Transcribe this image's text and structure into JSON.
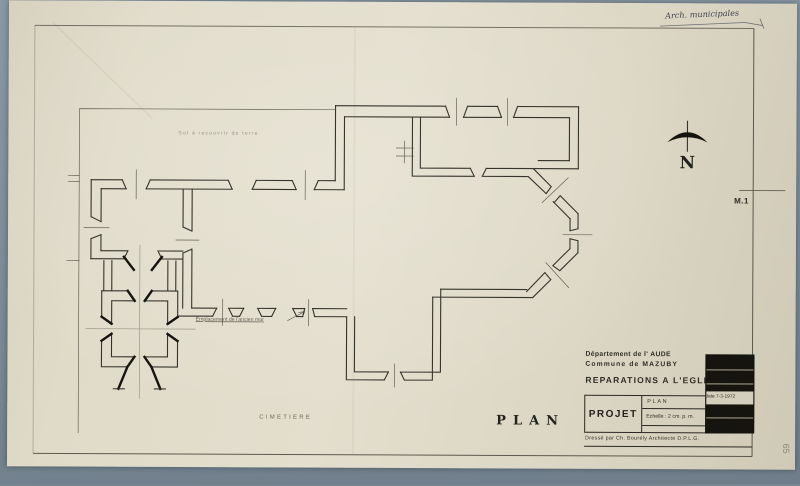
{
  "scan": {
    "annotation_top_right": "Arch. municipales",
    "sheet_tab": "M.1",
    "pencil_mark": "65"
  },
  "plan": {
    "caption": "PLAN",
    "yard_label": "Sol à recouvrir de terre",
    "wall_note": "Emplacement de l'ancien mur",
    "cemetery_label": "CIMETIERE",
    "north_letter": "N"
  },
  "title_block": {
    "department": "Département de l' AUDE",
    "commune": "Commune de  MAZUBY",
    "title": "REPARATIONS A L'EGLISE",
    "project": "PROJET",
    "drawing": "PLAN",
    "scale": "Echelle : 2 cm. p. m.",
    "date": "date 7-3-1972",
    "credit": "Dressé par Ch. Bourély  Architecte D.P.L.G."
  },
  "colors": {
    "mount": "#7f8e9a",
    "paper": "#ddd8c6",
    "ink": "#2e2d26",
    "heavy_ink": "#15140f"
  }
}
